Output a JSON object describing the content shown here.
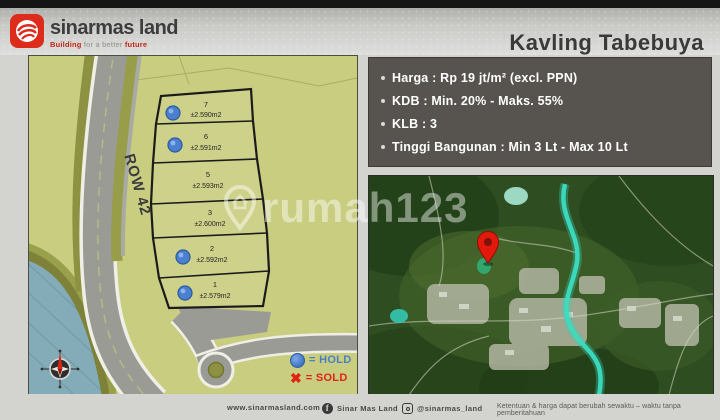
{
  "header": {
    "brand_name": "sinarmas land",
    "tagline_word1": "Building",
    "tagline_mid": " for a better ",
    "tagline_word2": "future",
    "title": "Kavling Tabebuya"
  },
  "info_box": {
    "items": [
      "Harga : Rp 19 jt/m² (excl. PPN)",
      "KDB : Min. 20% - Maks. 55%",
      "KLB : 3",
      "Tinggi Bangunan : Min 3 Lt - Max 10 Lt"
    ]
  },
  "site_plan": {
    "road_label": "ROW 42",
    "plots": [
      {
        "number": "7",
        "area": "±2.590m2",
        "status": "hold"
      },
      {
        "number": "6",
        "area": "±2.591m2",
        "status": "hold"
      },
      {
        "number": "5",
        "area": "±2.593m2",
        "status": "available"
      },
      {
        "number": "3",
        "area": "±2.600m2",
        "status": "available"
      },
      {
        "number": "2",
        "area": "±2.592m2",
        "status": "hold"
      },
      {
        "number": "1",
        "area": "±2.579m2",
        "status": "hold"
      }
    ],
    "legend": [
      {
        "symbol": "hold-circle",
        "label": "= HOLD"
      },
      {
        "symbol": "sold-x",
        "label": "= SOLD"
      }
    ]
  },
  "location_map": {
    "pin": "location-pin"
  },
  "watermark": "rumah123",
  "footer": {
    "website": "www.sinarmasland.com",
    "facebook": "Sinar Mas Land",
    "instagram": "@sinarmas_land",
    "disclaimer": "Ketentuan & harga dapat berubah sewaktu – waktu tanpa pemberitahuan"
  },
  "colors": {
    "brand_red": "#dd2b1c",
    "hold_blue": "#4a80cf",
    "sold_red": "#e02414",
    "land_green": "#c9cd80",
    "infobox_bg": "#57544f"
  }
}
